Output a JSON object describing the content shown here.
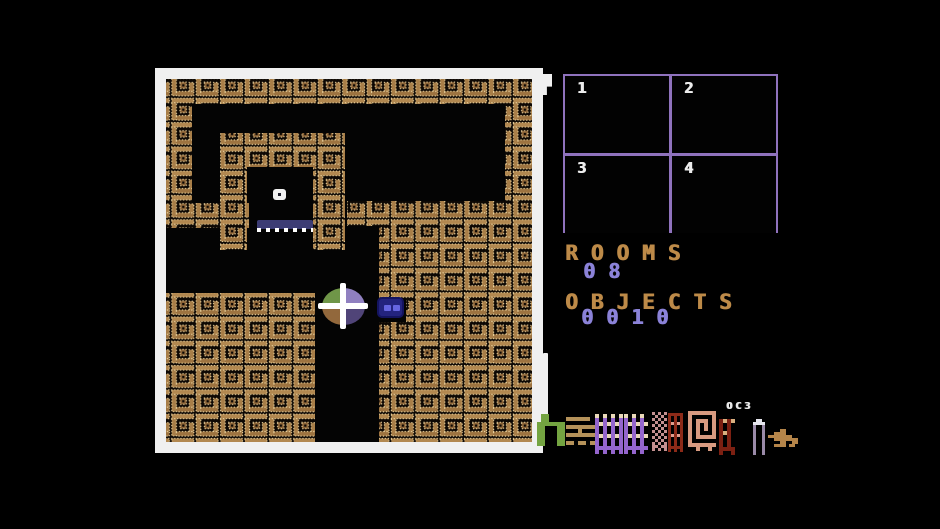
{
  "colors": {
    "white": "#f0f0f0",
    "brick_tan": "#a87e48",
    "brick_dot": "#ecd5a0",
    "minimap_purple": "#8f72bd",
    "label_tan": "#bd8a48",
    "value_periwinkle": "#8b82d8"
  },
  "playfield": {
    "frame": {
      "x": 155,
      "y": 68,
      "w": 388,
      "h": 385
    },
    "walls": [
      {
        "name": "top-wall",
        "x": 166,
        "y": 79,
        "w": 366,
        "h": 25
      },
      {
        "name": "left-wall",
        "x": 166,
        "y": 104,
        "w": 26,
        "h": 99
      },
      {
        "name": "left-stub",
        "x": 166,
        "y": 203,
        "w": 83,
        "h": 25
      },
      {
        "name": "room-top",
        "x": 220,
        "y": 133,
        "w": 125,
        "h": 34
      },
      {
        "name": "room-left",
        "x": 220,
        "y": 167,
        "w": 27,
        "h": 83
      },
      {
        "name": "room-right",
        "x": 313,
        "y": 167,
        "w": 32,
        "h": 83
      },
      {
        "name": "mid-band-a",
        "x": 347,
        "y": 201,
        "w": 185,
        "h": 25
      },
      {
        "name": "mid-band-b",
        "x": 379,
        "y": 226,
        "w": 153,
        "h": 25
      },
      {
        "name": "right-block-upper",
        "x": 379,
        "y": 251,
        "w": 153,
        "h": 47
      },
      {
        "name": "right-block-mid",
        "x": 406,
        "y": 298,
        "w": 126,
        "h": 24
      },
      {
        "name": "right-block-lower",
        "x": 379,
        "y": 322,
        "w": 153,
        "h": 120
      },
      {
        "name": "right-wall",
        "x": 505,
        "y": 104,
        "w": 27,
        "h": 97
      },
      {
        "name": "left-block",
        "x": 166,
        "y": 293,
        "w": 149,
        "h": 149
      }
    ],
    "room": {
      "dot": {
        "x": 273,
        "y": 189,
        "w": 13,
        "h": 11
      },
      "platform": {
        "x": 257,
        "y": 220,
        "w": 56,
        "h": 9,
        "color": "#3c3c74"
      },
      "platform_dashes": {
        "x": 257,
        "y": 228,
        "w": 56,
        "h": 4
      }
    },
    "ball": {
      "rect": {
        "x": 318,
        "y": 283,
        "w": 50,
        "h": 46
      },
      "colors": {
        "tl": "#6f9648",
        "tr": "#9080c0",
        "bl": "#92683c",
        "br": "#504478"
      }
    },
    "creature": {
      "rect": {
        "x": 377,
        "y": 297,
        "w": 27,
        "h": 21
      },
      "body": "#23237e",
      "eye": "#6565e0"
    }
  },
  "marker_tab": {
    "x": 537,
    "y": 74,
    "w": 15,
    "h": 30
  },
  "divider_line": {
    "x": 543,
    "y": 353,
    "w": 5,
    "h": 64
  },
  "minimap": {
    "cells": [
      {
        "label": "1"
      },
      {
        "label": "2"
      },
      {
        "label": "3"
      },
      {
        "label": "4"
      }
    ]
  },
  "stats": {
    "rooms_label": "ROOMS",
    "rooms_value": "08",
    "objects_label": "OBJECTS",
    "objects_value": "0010"
  },
  "mini_code": "OC3",
  "object_sprites": [
    {
      "name": "sprite-green-arch",
      "x": 537,
      "y": 414,
      "px": 4,
      "palette": {
        "a": "#74a441"
      },
      "rows": [
        ".aa....",
        ".aa....",
        "aaaaaaa",
        "aa...aa",
        "aa...aa",
        "aa...aa",
        "aa...aa",
        "aa...aa"
      ]
    },
    {
      "name": "sprite-tan-stack",
      "x": 566,
      "y": 417,
      "px": 4,
      "palette": {
        "b": "#b5925a"
      },
      "rows": [
        "bbbbbb..",
        "........",
        "bbbbbbbb",
        "...b....",
        "bbbbbbbb",
        "........",
        "bb.bb.bb"
      ]
    },
    {
      "name": "sprite-purple-cage-a",
      "x": 595,
      "y": 414,
      "px": 4,
      "palette": {
        "c": "#ead9b8",
        "d": "#9465cd"
      },
      "rows": [
        "c.c.c.c",
        "d.d.d.d",
        "dcdcdcd",
        "d.d.d.d",
        "d.d.d.d",
        "dcdcdcd",
        "d.d.d.d",
        "d.d.d.d",
        "ddddddd",
        "d.d.d.d"
      ]
    },
    {
      "name": "sprite-purple-cage-b",
      "x": 624,
      "y": 414,
      "px": 4,
      "palette": {
        "c": "#ead9b8",
        "d": "#9465cd"
      },
      "rows": [
        "c.c.c.",
        "d.d.d.",
        "dcdcdc",
        "d.d.d.",
        "d.d.d.",
        "dcdcdc",
        "d.d.d.",
        "d.d.d.",
        "dddddd",
        "d.d.d."
      ]
    },
    {
      "name": "sprite-mauve-dots",
      "x": 652,
      "y": 412,
      "px": 3,
      "palette": {
        "e": "#c49090"
      },
      "rows": [
        "e.e.e",
        ".e.e.",
        "e.e.e",
        ".e.e.",
        "e.e.e",
        ".e.e.",
        "e.e.e",
        ".e.e.",
        "e.e.e",
        ".e.e.",
        "e.e.e",
        "ee.ee",
        "e.e.e"
      ]
    },
    {
      "name": "sprite-red-bars",
      "x": 668,
      "y": 413,
      "px": 3,
      "palette": {
        "f": "#8c2a18",
        "g": "#e0a090"
      },
      "rows": [
        "fffff",
        "f.f.f",
        "f.f.f",
        "fgfgf",
        "f.f.f",
        "f.f.f",
        "f.f.f",
        "fgfgf",
        "f.f.f",
        "f.f.f",
        "f.f.f",
        "fffff",
        "f.f.f"
      ]
    },
    {
      "name": "sprite-salmon-spiral",
      "x": 688,
      "y": 411,
      "px": 4,
      "palette": {
        "g": "#d89a80"
      },
      "rows": [
        "ggggggg",
        "g.....g",
        "g.ggg.g",
        "g.g.g.g",
        "g.g.g.g",
        "g.g...g",
        "g.ggggg",
        "g......",
        "ggggggg",
        "..g..g."
      ]
    },
    {
      "name": "sprite-red-cage",
      "x": 719,
      "y": 419,
      "px": 4,
      "palette": {
        "h": "#7c2012",
        "i": "#d8b080"
      },
      "rows": [
        "hihi",
        "h.h.",
        "h.h.",
        "hih.",
        "h.h.",
        "h.h.",
        "h.h.",
        "hhhh",
        "h..h"
      ]
    },
    {
      "name": "sprite-grey-arch",
      "x": 753,
      "y": 419,
      "px": 3,
      "palette": {
        "j": "#e6e6ee",
        "k": "#9a8aa8"
      },
      "rows": [
        ".jj.",
        "jjjj",
        "k..k",
        "k..k",
        "k..k",
        "k..k",
        "k..k",
        "k..k",
        "k..k",
        "k..k",
        "k..k",
        "k..k"
      ]
    },
    {
      "name": "sprite-tan-sled",
      "x": 768,
      "y": 429,
      "px": 3,
      "palette": {
        "m": "#b5854a"
      },
      "rows": [
        "....mm....",
        "..mmmm....",
        "mmmmmmmm..",
        "..mmmmmmmm",
        "....mm..mm",
        "..mmmm.mm."
      ]
    }
  ]
}
